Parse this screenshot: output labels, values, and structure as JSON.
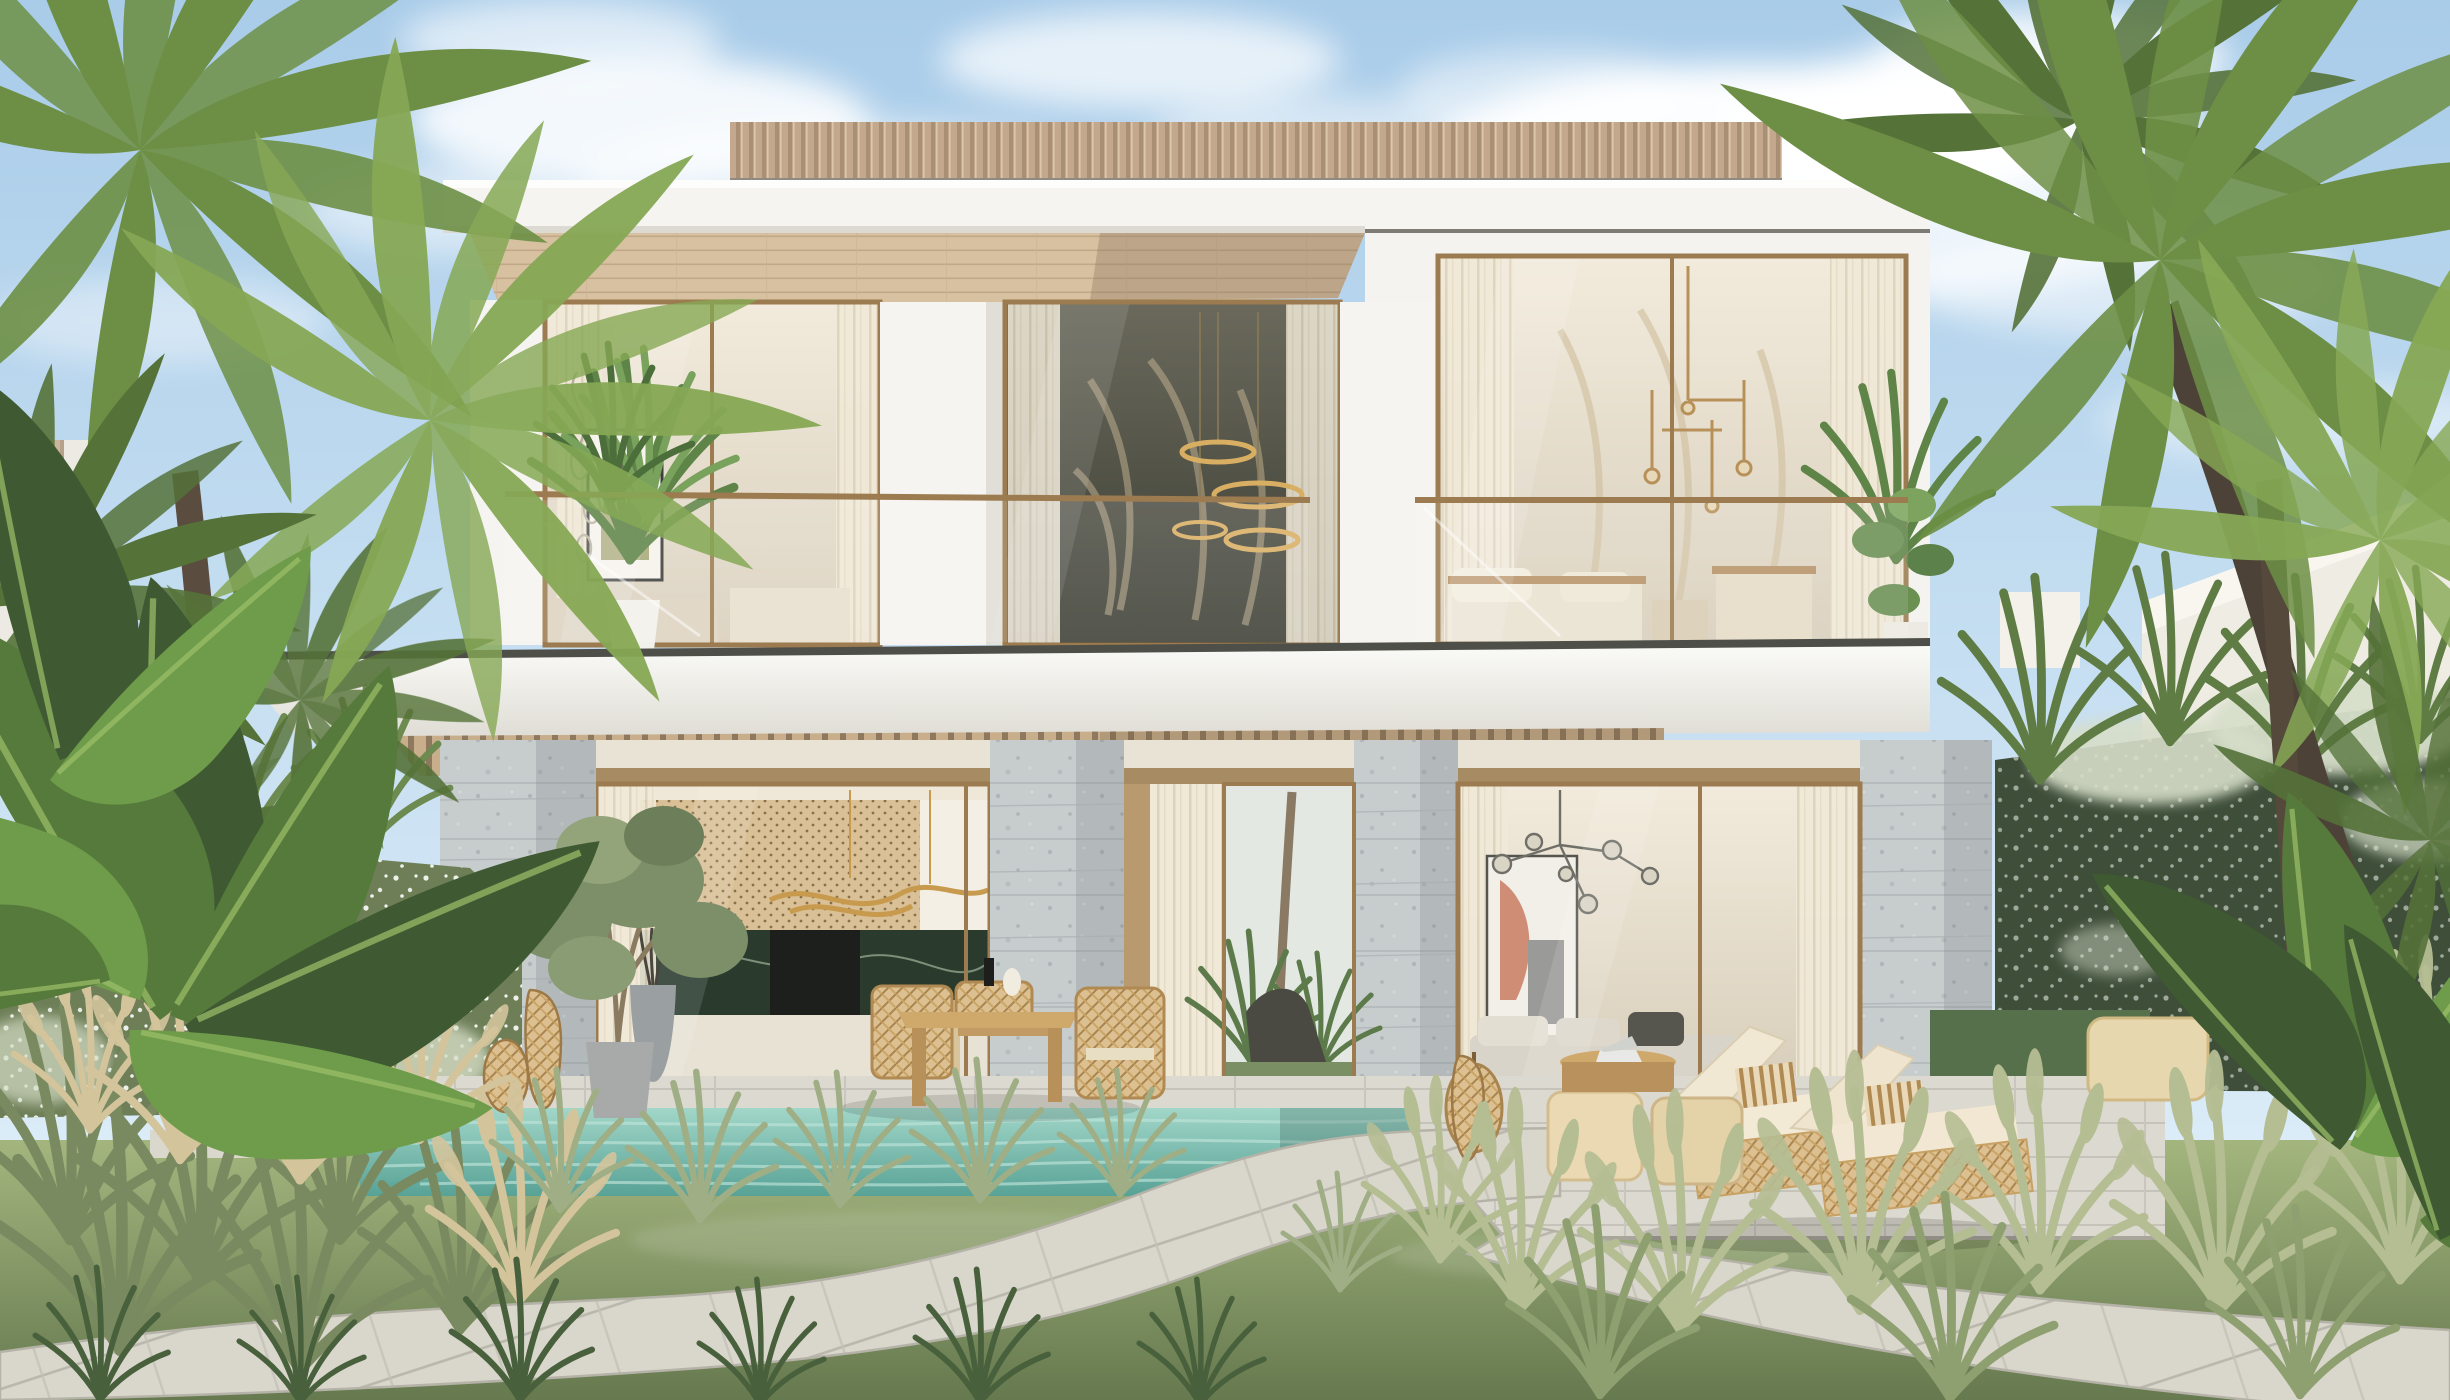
{
  "meta": {
    "title": "Tropical modern villa — exterior daylight render",
    "width_px": 2450,
    "height_px": 1400
  },
  "scene": {
    "description": "Sunny 3D exterior rendering of a modern two-storey white villa with a wood-slat roof parapet, deep roof overhang with wood soffit, floor-to-ceiling bronze-framed glazing, a glass-railed balcony with plants and outdoor seating, stone-clad ground-floor columns, a turquoise swimming pool, a curving stone paver path through a lawn with ornamental grasses, white flowering hedges and tall coconut palms under a blue sky with soft clouds.",
    "time_of_day": "day",
    "weather": "sunny with scattered clouds"
  },
  "villa": {
    "storeys": 2,
    "features": [
      "wood-slat roof parapet",
      "white flat roof fascia",
      "wood plank soffit under overhang",
      "upper-floor glass walls with sheer curtains",
      "glass balustrade balcony with bronze top rail",
      "balcony potted palm and monstera plants",
      "framed abstract artwork in bedroom",
      "ring-style gold pendant chandelier in double-height window",
      "branching glass-globe chandelier in living room",
      "stone-clad columns",
      "open sliding glass bay with view through to backyard palms",
      "kitchen with cane cabinet fronts, dark green marble island and wavy gold pendant light"
    ]
  },
  "furnishings_outdoor": [
    "light wood dining table with woven chairs",
    "two cream sun loungers with patterned cushions",
    "carved beige poufs and ottoman",
    "round wood coffee table with open laptop",
    "rattan lantern and vases",
    "potted olive tree",
    "grey planter with dry stems"
  ],
  "landscape": [
    "turquoise pool with stone coping",
    "stone terrace and steps",
    "curved paver walkway",
    "lawn",
    "sage ornamental grasses with wheat plumes",
    "white flowering hedge walls",
    "banana plants",
    "coconut palm trees",
    "neighbouring white villa walls"
  ],
  "palette": {
    "sky_top": "#a9cce9",
    "sky_horizon": "#e6f3fb",
    "cloud_white": "#ffffff",
    "roof_slat_wood": "#c3a88d",
    "wall_white": "#f5f4f0",
    "soffit_wood": "#d7c1a1",
    "frame_bronze": "#9b7b4f",
    "stone_light": "#c7cccd",
    "terrace_stone": "#dcd9d0",
    "path_paver": "#d9d6cc",
    "pool_shallow": "#a5d9cb",
    "pool_deep": "#58a296",
    "lawn_sun": "#a4b67e",
    "lawn_shade": "#66794f",
    "grass_sage": "#9fae85",
    "grass_plume": "#d3c49c",
    "palm_green": "#6d8f45",
    "palm_trunk": "#5a4c3e",
    "hedge_dark": "#3e4e39",
    "flower_white": "#e9ede7",
    "marble_green": "#2a3b2e",
    "gold_accent": "#c79a4e",
    "cushion_cream": "#f1e8d4",
    "wood_furniture": "#cfa96c"
  }
}
